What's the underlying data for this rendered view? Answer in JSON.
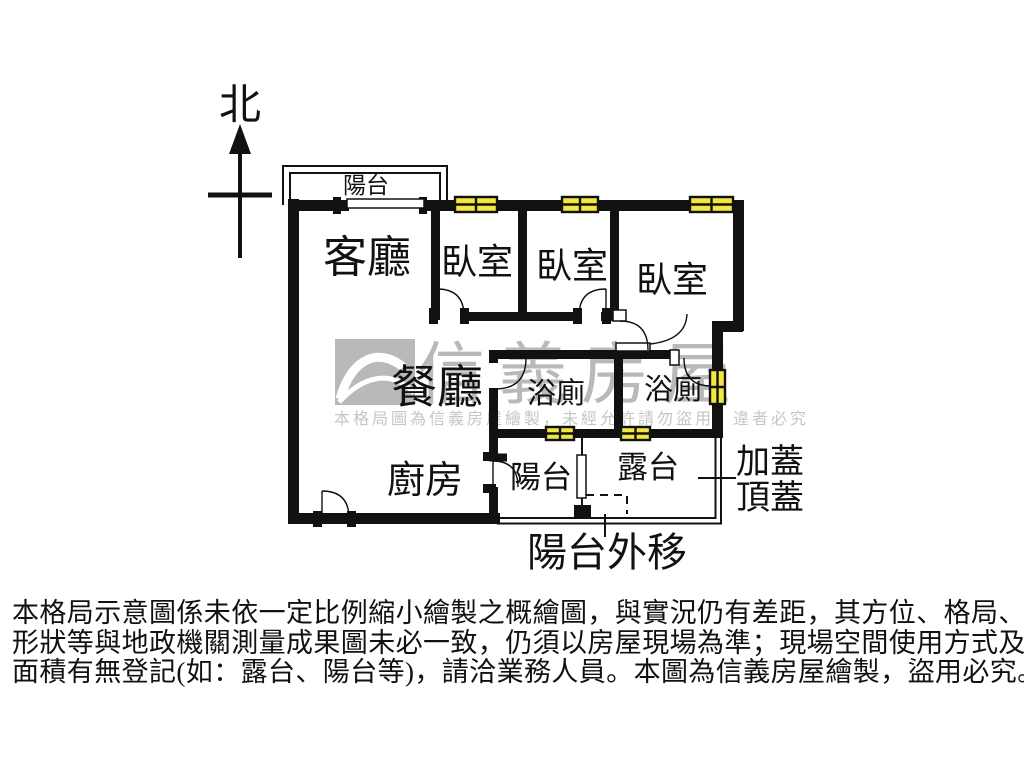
{
  "compass": {
    "label": "北"
  },
  "rooms": {
    "balcony_top": "陽台",
    "living": "客廳",
    "bedroom1": "臥室",
    "bedroom2": "臥室",
    "bedroom3": "臥室",
    "dining": "餐廳",
    "bath1": "浴廁",
    "bath2": "浴廁",
    "kitchen": "廚房",
    "balcony_bottom": "陽台",
    "terrace": "露台",
    "roof_cover_line1": "加蓋",
    "roof_cover_line2": "頂蓋",
    "balcony_extension": "陽台外移"
  },
  "watermark": {
    "brand": "信義房屋",
    "logo": "sinyi-roof-logo",
    "notice": "本格局圖為信義房屋繪製，未經允許請勿盜用，違者必究"
  },
  "disclaimer": {
    "line1": "本格局示意圖係未依一定比例縮小繪製之概繪圖，與實況仍有差距，其方位、格局、",
    "line2": "形狀等與地政機關測量成果圖未必一致，仍須以房屋現場為準；現場空間使用方式及",
    "line3": "面積有無登記(如：露台、陽台等)，請洽業務人員。本圖為信義房屋繪製，盜用必究。"
  },
  "colors": {
    "wall": "#111111",
    "window_fill": "#f2e73e",
    "watermark_gray": "#b9b9b9",
    "watermark_text_gray": "#c6c6c6",
    "background": "#ffffff"
  }
}
